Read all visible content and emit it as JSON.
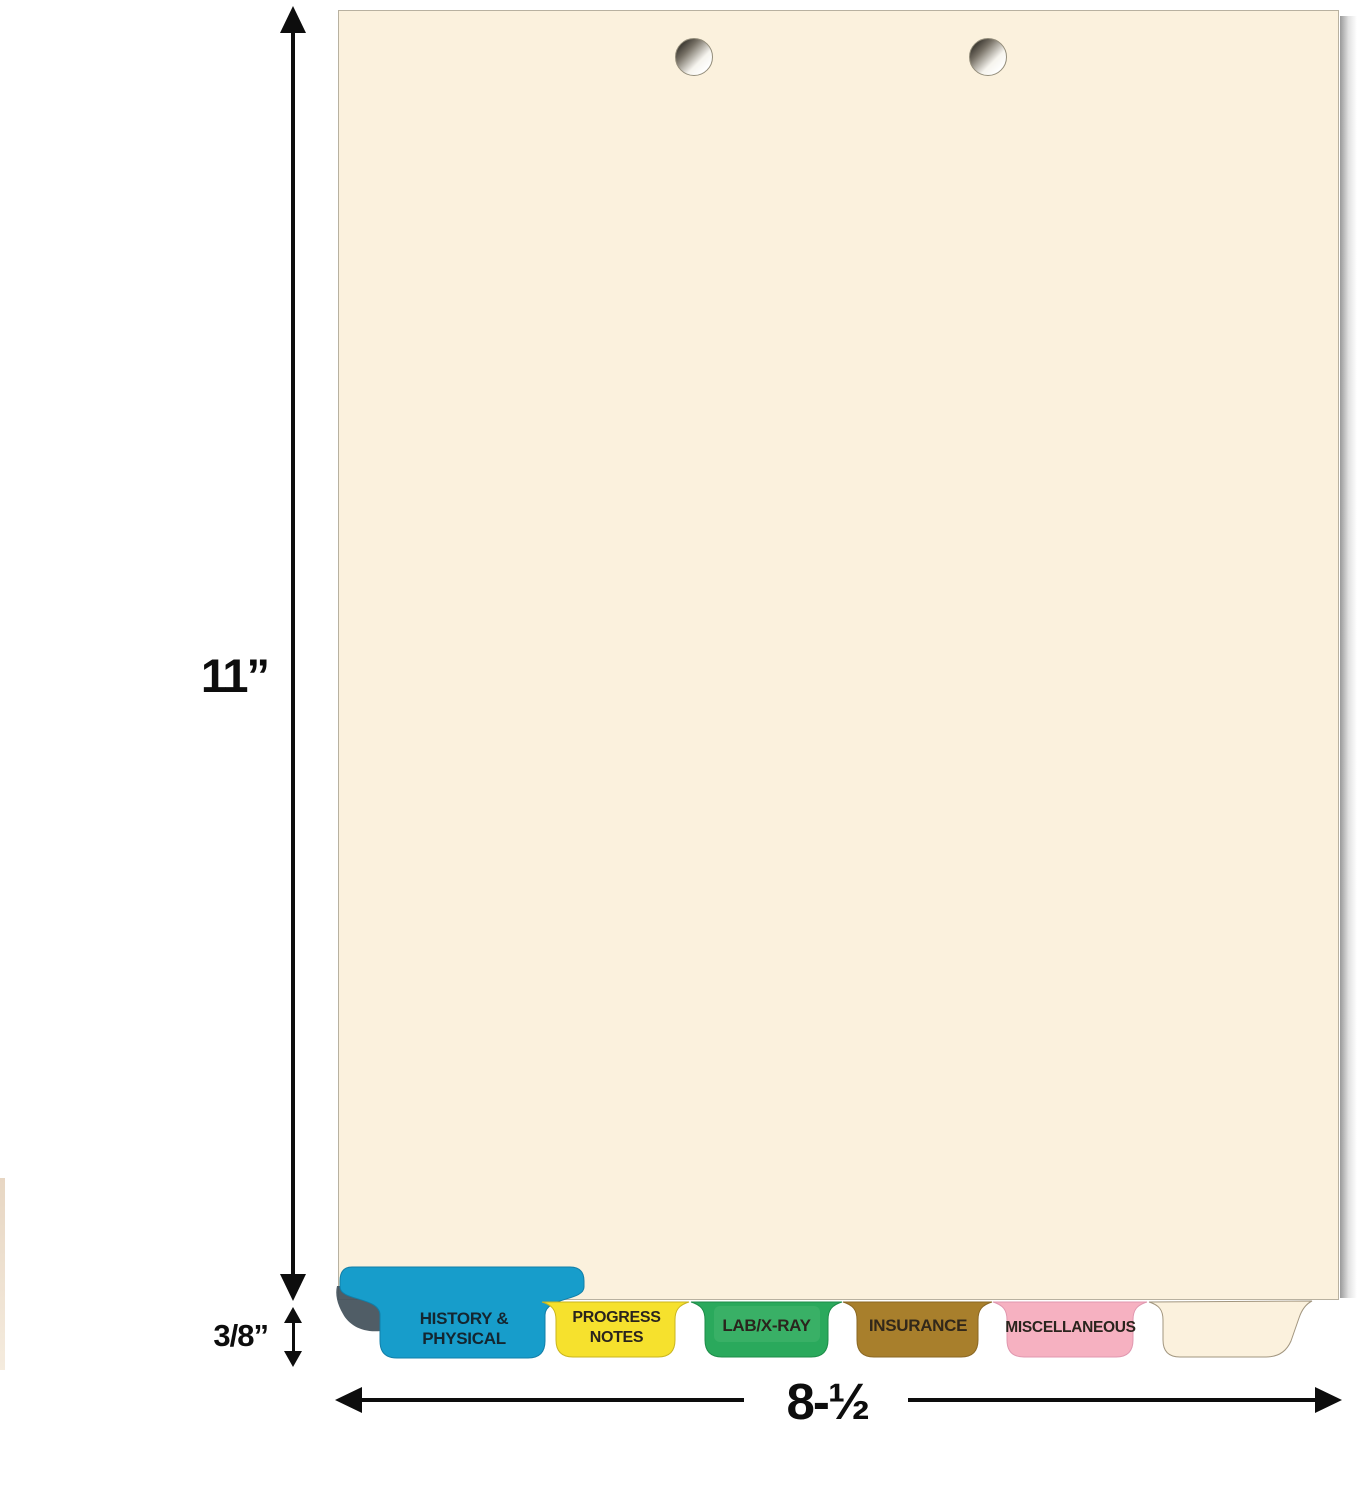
{
  "image": {
    "type": "product-dimension-diagram",
    "subject": "Manila medical chart divider sheet, 2-hole punched, with color side-bottom index tabs"
  },
  "sheet": {
    "color": "#fbf1dd",
    "hole_count": 2
  },
  "dimensions": {
    "height": "11”",
    "tab_height": "3/8”",
    "width": "8-½"
  },
  "tabs": [
    {
      "label": "HISTORY & PHYSICAL",
      "line1": "HISTORY &",
      "line2": "PHYSICAL",
      "color": "#179dcb",
      "fold_shadow_color": "#414f59"
    },
    {
      "label": "PROGRESS NOTES",
      "color": "#f6e12d"
    },
    {
      "label": "LAB/X-RAY",
      "color": "#2aa95c",
      "highlight_color": "#4cb873"
    },
    {
      "label": "INSURANCE",
      "color": "#a87f2c"
    },
    {
      "label": "MISCELLANEOUS",
      "color": "#f6b1c1"
    },
    {
      "label": "",
      "color": "#fbf1dd"
    }
  ]
}
